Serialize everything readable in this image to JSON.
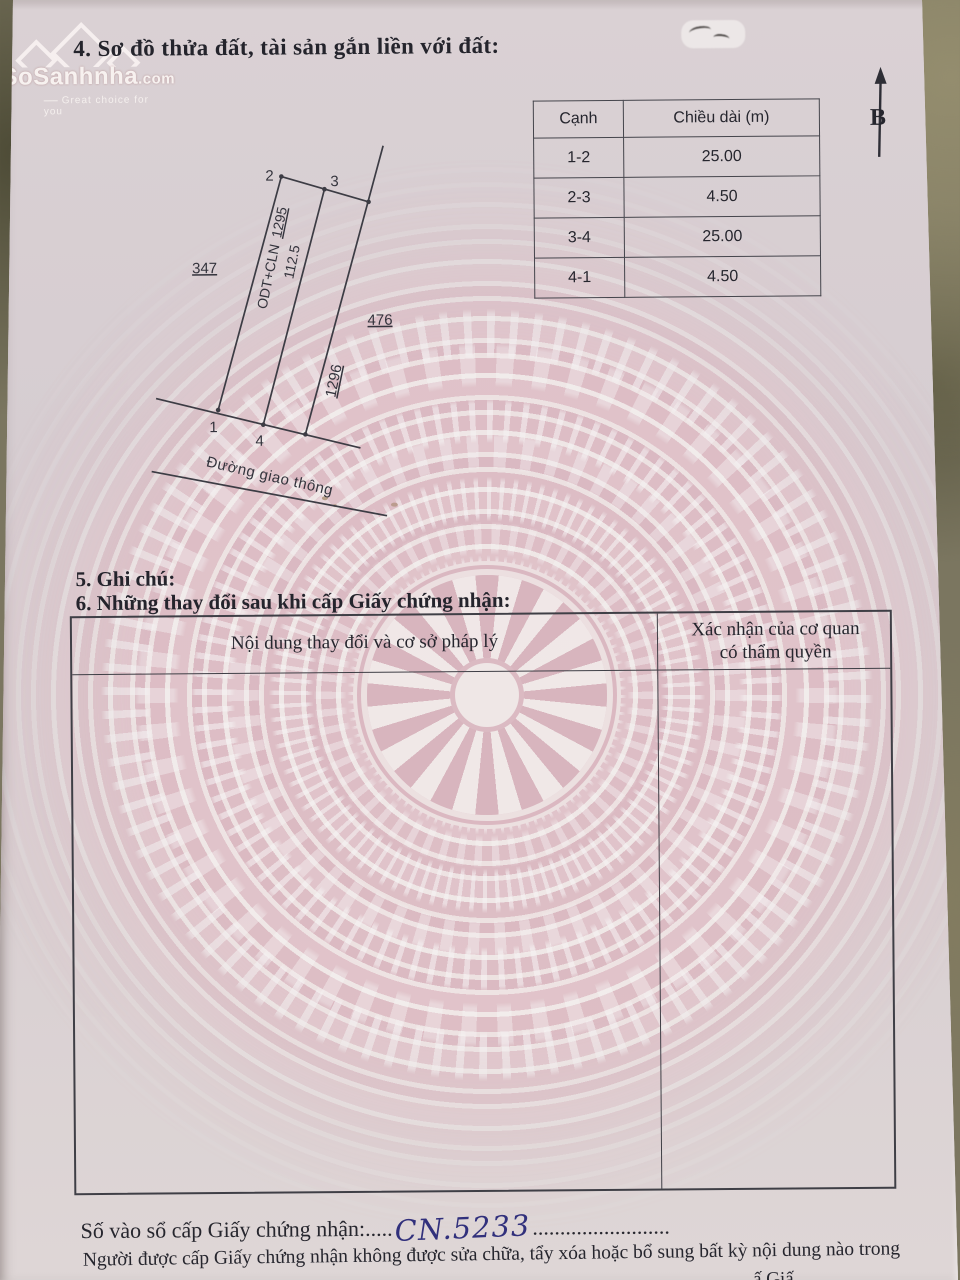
{
  "page": {
    "section4_title": "4. Sơ đồ thửa đất, tài sản gắn liền với đất:",
    "section5_title": "5. Ghi chú:",
    "section6_title": "6. Những thay đổi sau khi cấp Giấy chứng nhận:",
    "registry_label": "Số vào sổ cấp Giấy chứng nhận:",
    "registry_dots_left": ".....",
    "registry_number": "CN.5233",
    "registry_dots_right": ".........................",
    "footer_text": "Người được cấp Giấy chứng nhận không được sửa chữa, tẩy xóa hoặc bổ sung bất kỳ nội dung nào trong",
    "footer_fragment": "ấ Giấ"
  },
  "watermark_logo": {
    "brand": "SoSanhnha",
    "domain": ".com",
    "tagline": "Great choice for you"
  },
  "north_arrow": {
    "label": "B"
  },
  "edge_table": {
    "headers": [
      "Cạnh",
      "Chiều dài (m)"
    ],
    "rows": [
      [
        "1-2",
        "25.00"
      ],
      [
        "2-3",
        "4.50"
      ],
      [
        "3-4",
        "25.00"
      ],
      [
        "4-1",
        "4.50"
      ]
    ]
  },
  "diagram": {
    "corners": {
      "p1": "1",
      "p2": "2",
      "p3": "3",
      "p4": "4"
    },
    "parcel_code": "ODT+CLN",
    "parcel_number": "1295",
    "parcel_area": "112.5",
    "neighbor_left": "347",
    "neighbor_right": "476",
    "neighbor_parcel": "1296",
    "road_label": "Đường giao thông"
  },
  "changes_table": {
    "col1_header": "Nội dung thay đổi và cơ sở pháp lý",
    "col2_header_line1": "Xác nhận của cơ quan",
    "col2_header_line2": "có thẩm quyền"
  },
  "colors": {
    "paper": "#d8ced2",
    "watermark_pink": "#ddb7c0",
    "ink": "#2b2b33",
    "handwriting_ink": "#31307c",
    "table_border": "#3f3f46",
    "background_olive": "#7b7660"
  }
}
